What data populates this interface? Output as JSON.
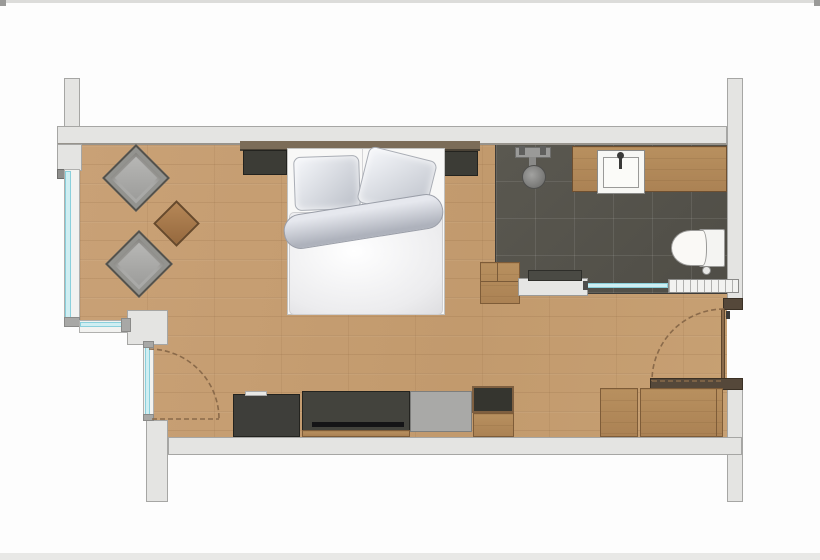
{
  "meta": {
    "type": "floor-plan",
    "description": "Top-down architectural floor plan of a hotel studio room: bedroom-living area with wood floor, sitting corner, double bed, media sideboard and wardrobe, plus an open dark-tiled bathroom with shower, vanity, toilet and towel radiator"
  },
  "palette": {
    "background": "#fdfdfd",
    "wall_fill": "#e4e4e2",
    "wall_border": "#a6a6a4",
    "wood_floor": "#c69e73",
    "bathroom_tile": "#55534d",
    "glass": "#cfeef2",
    "furniture_wood": "#b28a5d",
    "furniture_dark": "#3e3e3a",
    "textile_gray": "#a9a9a7",
    "bedding_white": "#f8f8f7",
    "door_swing": "#8a6a4a",
    "dark_wood_trim": "#55483a"
  },
  "rooms": {
    "bedroom": {
      "name": "bedroom-living-area",
      "floor": "wood planks",
      "furniture": [
        "double-bed",
        "headboard",
        "nightstand-left",
        "nightstand-right",
        "armchair-upper",
        "armchair-lower",
        "side-table",
        "media-sideboard",
        "tv-panel",
        "luggage-bench",
        "minibar-cabinet",
        "wardrobe"
      ]
    },
    "bathroom": {
      "name": "open-bathroom",
      "floor": "dark tiles",
      "fixtures": [
        "walk-in-shower",
        "shower-head",
        "vanity-counter",
        "washbasin",
        "toilet",
        "towel-radiator",
        "glass-partition",
        "storage-bench"
      ]
    },
    "openings": [
      "entrance-door",
      "balcony-door",
      "window-left",
      "window-corner"
    ]
  },
  "items": {
    "bed": "Double bed",
    "pillow_left": "Pillow",
    "pillow_right": "Pillow",
    "rolled_duvet": "Rolled duvet",
    "duvet": "Duvet",
    "headboard": "Headboard",
    "nightstand_left": "Nightstand",
    "nightstand_right": "Nightstand",
    "armchair_upper": "Armchair",
    "armchair_lower": "Armchair",
    "side_table": "Side table",
    "sideboard": "Sideboard",
    "tv_panel": "TV panel",
    "luggage_bench": "Luggage bench",
    "minibar": "Minibar cabinet",
    "wardrobe_left": "Wardrobe",
    "wardrobe_right": "Wardrobe",
    "shower": "Shower fitting",
    "shower_head": "Shower head",
    "vanity": "Vanity counter",
    "sink": "Washbasin",
    "faucet": "Faucet",
    "toilet": "Toilet",
    "radiator": "Towel radiator",
    "glass_partition": "Glass partition",
    "bath_bench": "Storage bench",
    "bench_cushion": "Bench cushion",
    "entrance_door": "Entrance door",
    "balcony_door": "Balcony door",
    "window_left": "Window",
    "window_corner": "Corner window"
  }
}
